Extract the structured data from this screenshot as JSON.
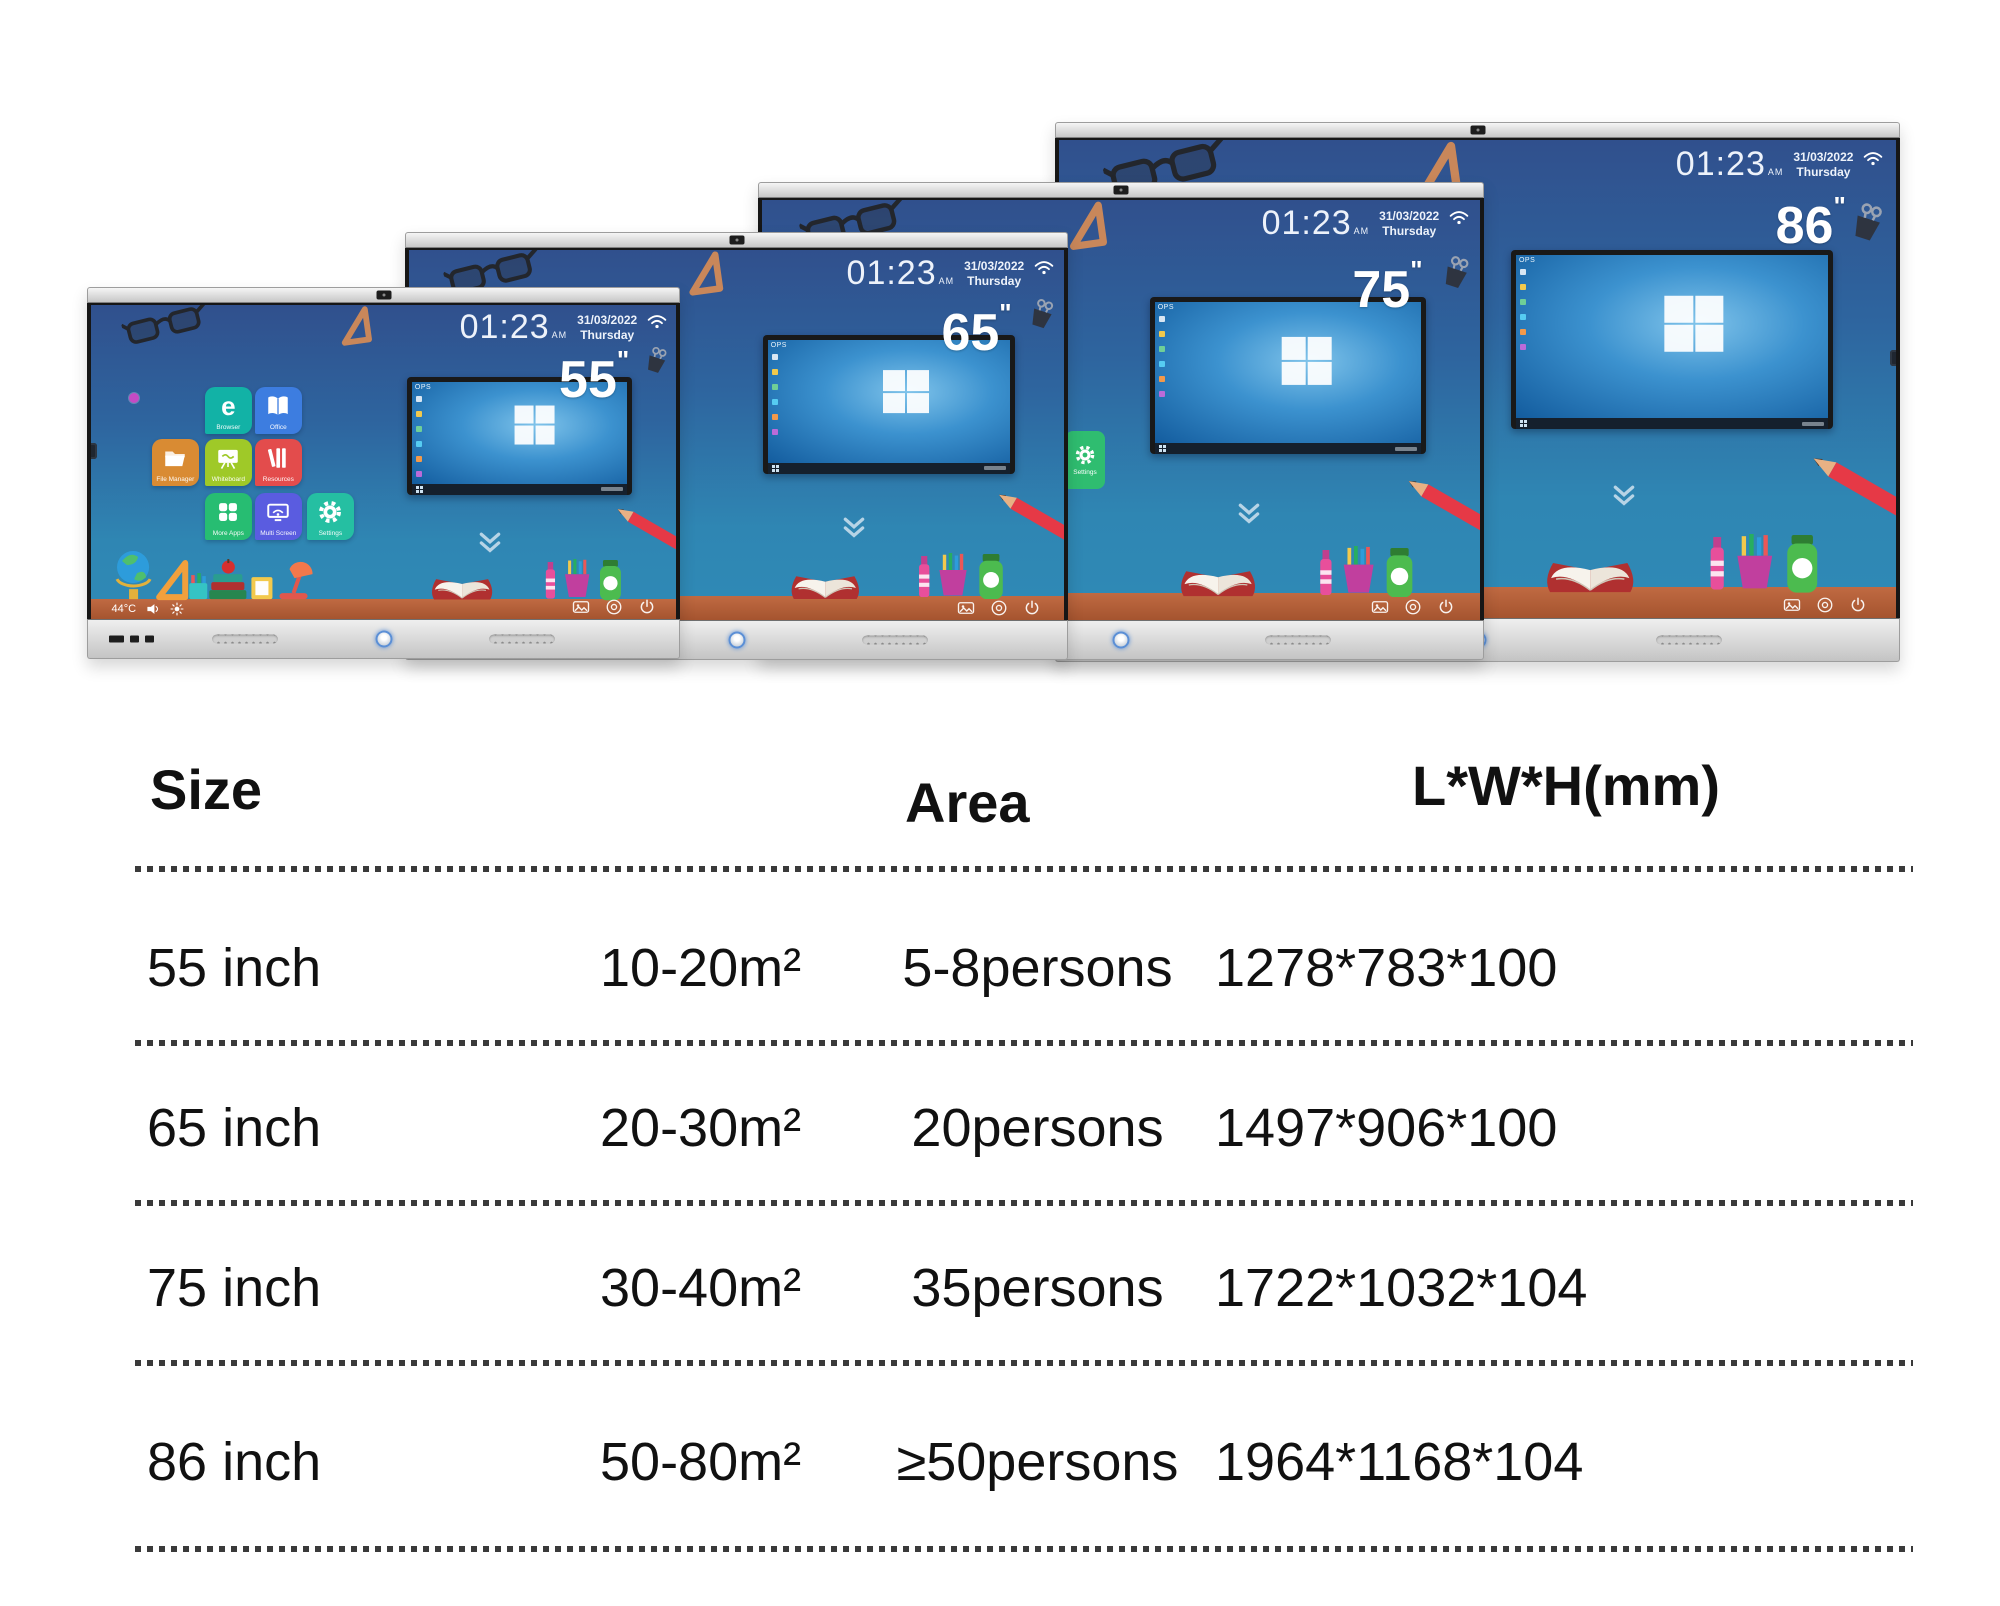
{
  "screen_ui": {
    "clock": "01:23",
    "meridiem": "AM",
    "date": "31/03/2022",
    "weekday": "Thursday",
    "inch_mark": "\"",
    "window_badge": "OPS",
    "temperature": "44°C",
    "settings_tab_label": "Settings"
  },
  "panels": [
    {
      "size_label": "55"
    },
    {
      "size_label": "65"
    },
    {
      "size_label": "75"
    },
    {
      "size_label": "86"
    }
  ],
  "apps": [
    {
      "label": "Browser",
      "glyph": "e",
      "color": "#12b2a6"
    },
    {
      "label": "Office",
      "color": "#3d7de0"
    },
    {
      "label": "File Manager",
      "color": "#d98b33"
    },
    {
      "label": "Whiteboard",
      "color": "#9fc928"
    },
    {
      "label": "Resources",
      "color": "#e34c4c"
    },
    {
      "label": "More Apps",
      "color": "#27bd72"
    },
    {
      "label": "Multi Screen",
      "color": "#5a5ce0"
    },
    {
      "label": "Settings",
      "color": "#25bfa2"
    }
  ],
  "table": {
    "headers": [
      "Size",
      "Area",
      "L*W*H(mm)"
    ],
    "rows": [
      {
        "size": "55 inch",
        "area": "10-20m²",
        "persons": "5-8persons",
        "lwh": "1278*783*100"
      },
      {
        "size": "65 inch",
        "area": "20-30m²",
        "persons": "20persons",
        "lwh": "1497*906*100"
      },
      {
        "size": "75 inch",
        "area": "30-40m²",
        "persons": "35persons",
        "lwh": "1722*1032*104"
      },
      {
        "size": "86 inch",
        "area": "50-80m²",
        "persons": "≥50persons",
        "lwh": "1964*1168*104"
      }
    ]
  },
  "colors": {
    "screen_gradient_top": "#30508d",
    "screen_gradient_bottom": "#2f8ab6",
    "desk_wood": "#a5542f",
    "bezel_silver": "#d9d9d9",
    "settings_tab_green": "#2fbd70",
    "windows_blue": "#2f87c8",
    "table_text": "#111111"
  }
}
